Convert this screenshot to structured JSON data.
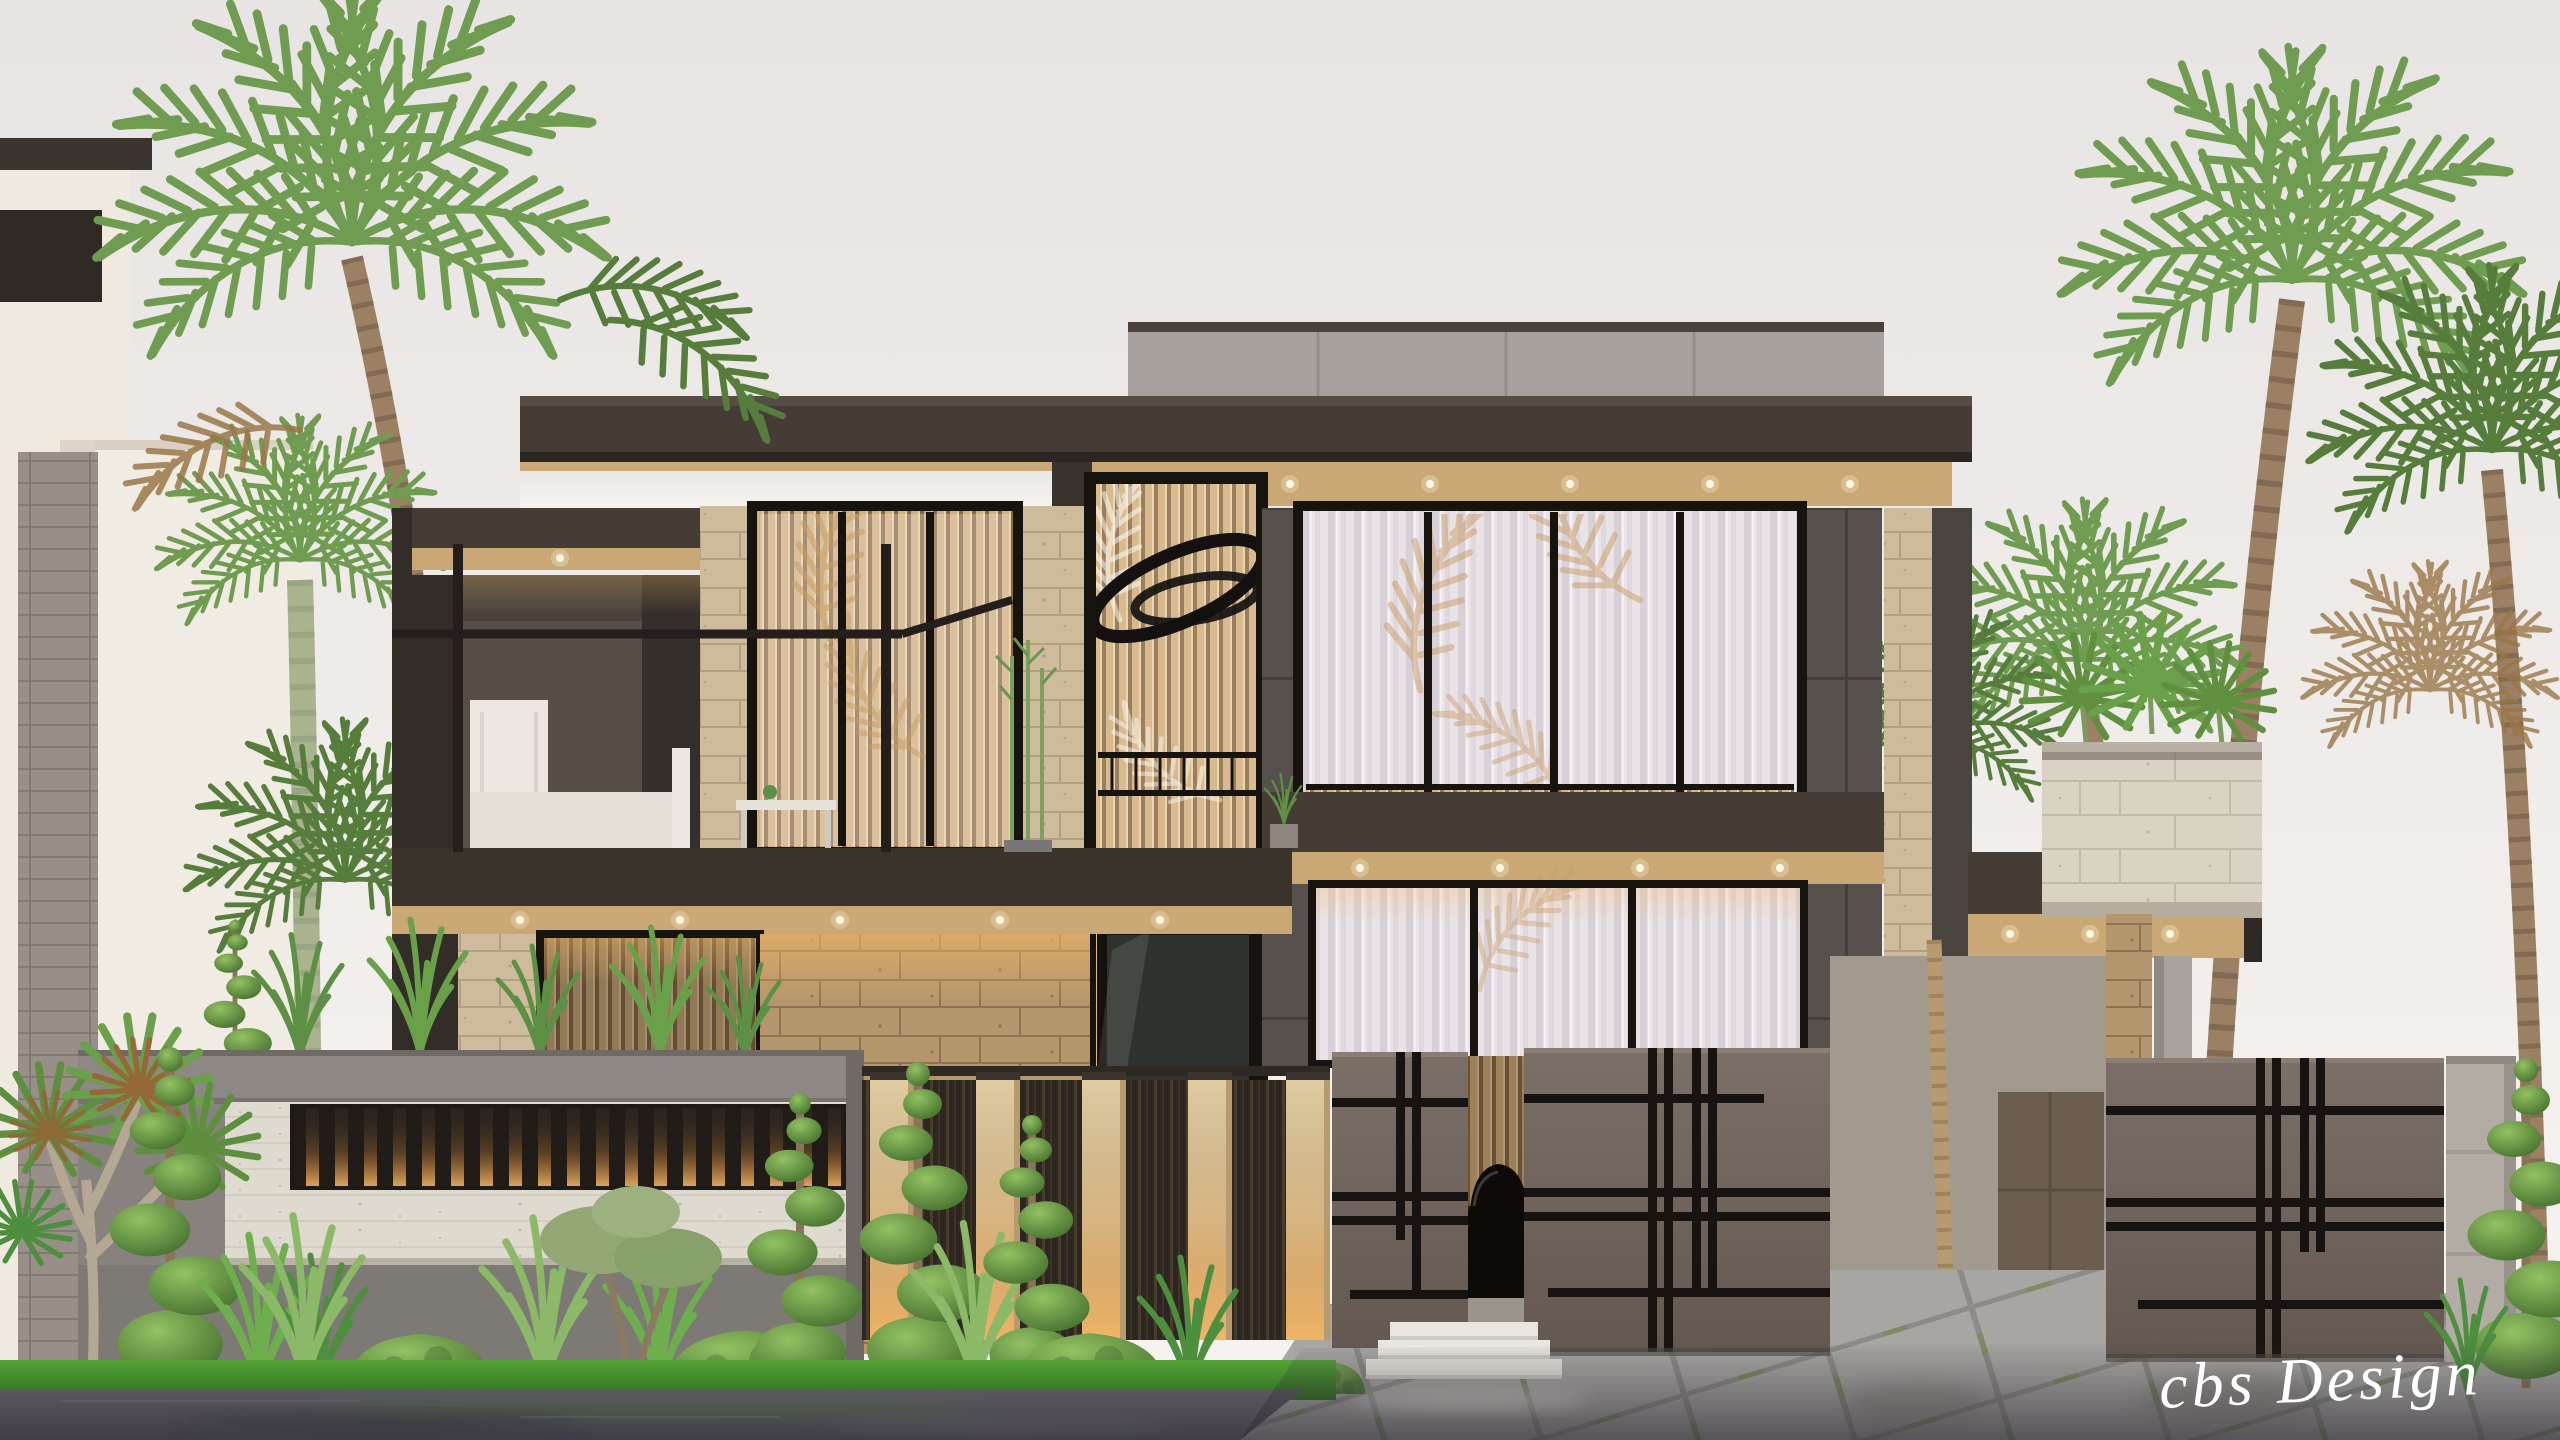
{
  "watermark": {
    "text": "cbs Design"
  },
  "scene": {
    "subject": "modern-two-storey-villa-exterior-render",
    "sky": "overcast pale sky",
    "elements": [
      "flat dark roof fascia with wood soffit and LED cove lighting",
      "grey rooftop parapet box",
      "black steel pergola over first-floor balcony with white outdoor sofa",
      "travertine stone cladding walls",
      "double-height entry glazing with vertical wood slats and black ring artwork",
      "large windows with sheer curtains and palm shadows",
      "cantilevered beam with travertine roof planter and yuccas",
      "boundary wall with illuminated vertical slat grille",
      "taupe driveway gates with black groove plaid pattern",
      "pedestrian gap with car silhouette and white entry steps",
      "light concrete gate pillar",
      "palm trees, spiral topiaries, dome shrubs, ornamental grasses",
      "diagonal paved driveway with moss joints",
      "wet reflective asphalt foreground"
    ]
  },
  "palette": {
    "sky_top": "#e7e4e3",
    "sky_bottom": "#f6f3f0",
    "fascia": "#453c35",
    "fascia_deep": "#2b2622",
    "wood_soffit": "#c9a876",
    "travertine": "#cdbb9b",
    "travertine_joint": "#b3a082",
    "travertine_dark": "#b4966c",
    "cladding": "#56514d",
    "concrete": "#574f47",
    "concrete_dark": "#342f2a",
    "parapet": "#a6a19d",
    "white_panel": "#dfdad0",
    "white_building": "#efe9df",
    "gate": "#6f635d",
    "groove": "#171310",
    "pillar": "#b3aca4",
    "curtain_shadow": "#c79c63",
    "led": "#ffefc8",
    "grass": "#3f8f2b",
    "bush": "#5c8f3e",
    "palm": "#6f9c50",
    "palm_dark": "#567d3c",
    "palm_brown": "#9a7748",
    "trunk": "#9b8063",
    "trunk_green": "#a9b38d",
    "paver": "#a8a6a3",
    "paver_joint": "#8d8b88",
    "moss": "#7f8a5f",
    "road": "#534f58",
    "steps": "#e9e6df",
    "car": "#0d0b0a",
    "frame_black": "#17130f",
    "watermark": "#ffffff"
  }
}
